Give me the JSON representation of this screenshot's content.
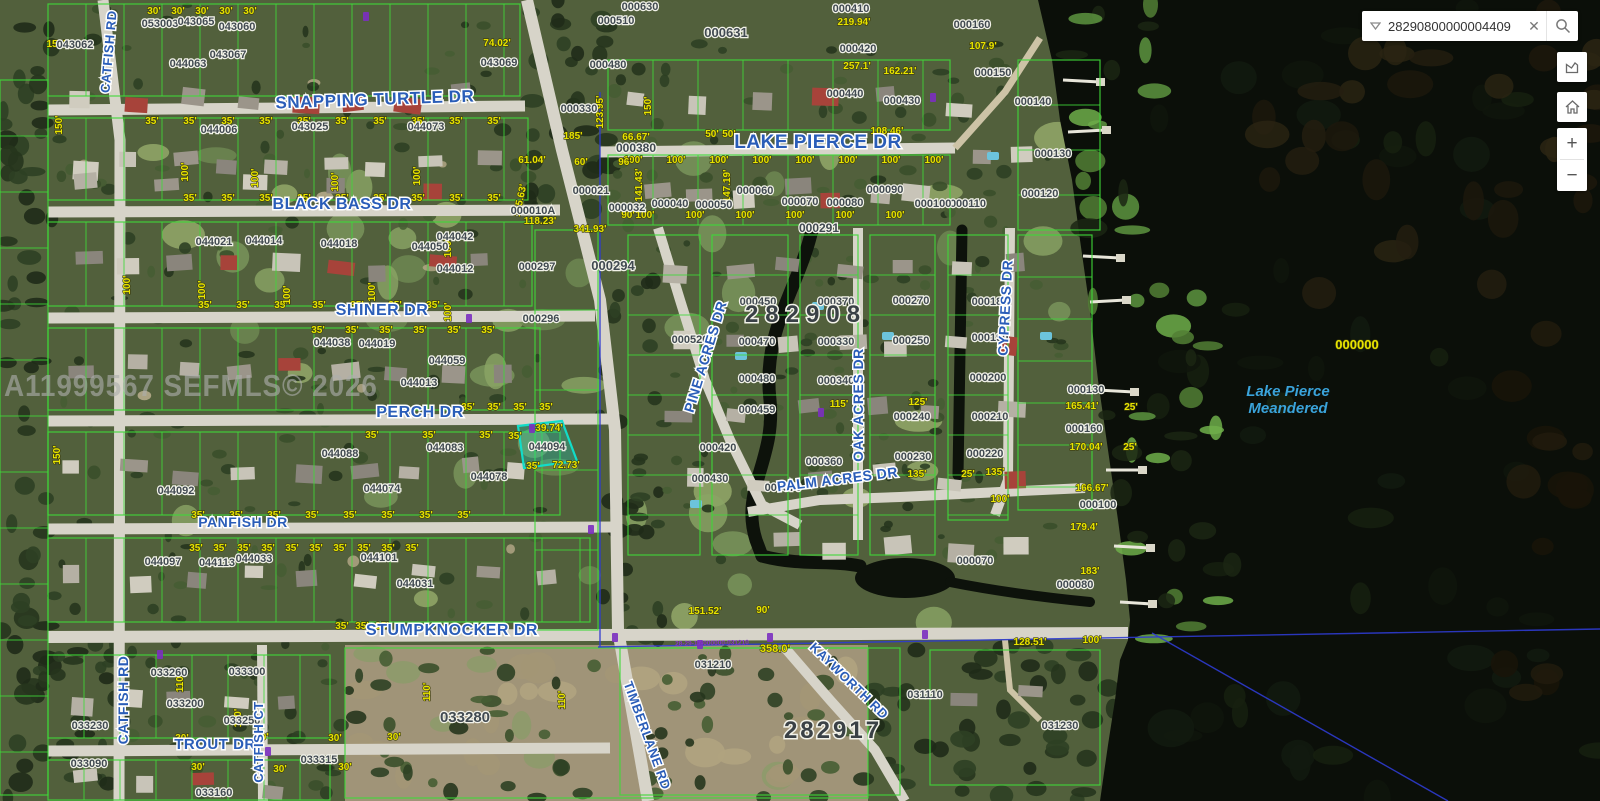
{
  "search": {
    "value": "28290800000004409"
  },
  "controls": {
    "zoom_in": "+",
    "zoom_out": "−"
  },
  "watermark": "A11999567 SEFMLS© 2026",
  "map": {
    "streets": [
      [
        "SNAPPING TURTLE DR",
        375,
        105,
        17,
        -2
      ],
      [
        "LAKE PIERCE DR",
        818,
        148,
        19,
        0
      ],
      [
        "BLACK BASS DR",
        342,
        209,
        16,
        0
      ],
      [
        "SHINER DR",
        382,
        315,
        16,
        0
      ],
      [
        "PERCH DR",
        420,
        417,
        16,
        0
      ],
      [
        "PANFISH DR",
        243,
        527,
        14,
        0
      ],
      [
        "STUMPKNOCKER DR",
        452,
        635,
        16,
        0
      ],
      [
        "TROUT DR",
        215,
        749,
        15,
        0
      ],
      [
        "CATFISH RD",
        113,
        52,
        13,
        -85
      ],
      [
        "CATFISH RD",
        128,
        700,
        14,
        -90
      ],
      [
        "CATFISH CT",
        263,
        742,
        13,
        -90
      ],
      [
        "PINE ACRES DR",
        710,
        358,
        14,
        -73
      ],
      [
        "OAK ACRES DR",
        863,
        405,
        14,
        -90
      ],
      [
        "CYPRESS DR",
        1010,
        308,
        14,
        -87
      ],
      [
        "PALM ACRES DR",
        838,
        484,
        14,
        -7
      ],
      [
        "KAYWORTH RD",
        846,
        684,
        13,
        44
      ],
      [
        "TIMBERLANE RD",
        643,
        737,
        13,
        70
      ]
    ],
    "sections": [
      [
        "282908",
        806,
        322,
        24,
        7
      ],
      [
        "282917",
        833,
        738,
        24,
        3
      ]
    ],
    "water_label": {
      "line1": "Lake Pierce",
      "line2": "Meandered"
    },
    "lake_parcel": "000000",
    "parcel_id_line": "28-29-17-000000-031210",
    "parcels": [
      [
        "000630",
        640,
        10
      ],
      [
        "000510",
        616,
        24
      ],
      [
        "000631",
        726,
        37,
        13
      ],
      [
        "000410",
        851,
        12
      ],
      [
        "000160",
        972,
        28
      ],
      [
        "000420",
        858,
        52
      ],
      [
        "000480",
        608,
        68
      ],
      [
        "000330",
        579,
        112
      ],
      [
        "000440",
        845,
        97
      ],
      [
        "000430",
        902,
        104
      ],
      [
        "000150",
        993,
        76
      ],
      [
        "000140",
        1033,
        105
      ],
      [
        "000130",
        1053,
        157
      ],
      [
        "000120",
        1040,
        197
      ],
      [
        "000110",
        968,
        207
      ],
      [
        "043062",
        75,
        48
      ],
      [
        "053003",
        160,
        27
      ],
      [
        "043065",
        196,
        25
      ],
      [
        "043060",
        237,
        30
      ],
      [
        "043067",
        228,
        58
      ],
      [
        "044063",
        188,
        67
      ],
      [
        "043069",
        499,
        66
      ],
      [
        "044006",
        219,
        133
      ],
      [
        "043025",
        310,
        130
      ],
      [
        "044073",
        426,
        130
      ],
      [
        "000380",
        636,
        152,
        12
      ],
      [
        "000032",
        627,
        211
      ],
      [
        "000040",
        670,
        207
      ],
      [
        "000050",
        714,
        208
      ],
      [
        "000060",
        755,
        194
      ],
      [
        "000070",
        800,
        205
      ],
      [
        "000080",
        845,
        206
      ],
      [
        "000090",
        885,
        193
      ],
      [
        "000100",
        933,
        207
      ],
      [
        "000291",
        819,
        232,
        12
      ],
      [
        "044021",
        214,
        245
      ],
      [
        "044014",
        264,
        244
      ],
      [
        "044018",
        339,
        247
      ],
      [
        "044050",
        430,
        250
      ],
      [
        "044042",
        455,
        240
      ],
      [
        "044012",
        455,
        272
      ],
      [
        "000010A",
        533,
        214
      ],
      [
        "000021",
        591,
        194
      ],
      [
        "000297",
        537,
        270
      ],
      [
        "000294",
        613,
        270,
        13
      ],
      [
        "000296",
        541,
        322
      ],
      [
        "044038",
        332,
        346
      ],
      [
        "044019",
        377,
        347
      ],
      [
        "044059",
        447,
        364
      ],
      [
        "044013",
        419,
        386
      ],
      [
        "044088",
        340,
        457
      ],
      [
        "044083",
        445,
        451
      ],
      [
        "044078",
        489,
        480
      ],
      [
        "044094",
        547,
        450
      ],
      [
        "044092",
        176,
        494
      ],
      [
        "044074",
        382,
        492
      ],
      [
        "044097",
        163,
        565
      ],
      [
        "044113",
        217,
        566
      ],
      [
        "044033",
        254,
        562
      ],
      [
        "044101",
        379,
        561
      ],
      [
        "044031",
        415,
        587
      ],
      [
        "033260",
        169,
        676
      ],
      [
        "033300",
        247,
        675
      ],
      [
        "033200",
        185,
        707
      ],
      [
        "033230",
        90,
        729
      ],
      [
        "033250",
        242,
        724
      ],
      [
        "033090",
        89,
        767
      ],
      [
        "033315",
        319,
        763
      ],
      [
        "033160",
        214,
        796
      ],
      [
        "033280",
        465,
        722,
        15
      ],
      [
        "031210",
        713,
        668
      ],
      [
        "031110",
        925,
        698
      ],
      [
        "031230",
        1060,
        729
      ],
      [
        "000450",
        758,
        305
      ],
      [
        "000370",
        836,
        305
      ],
      [
        "000270",
        911,
        304
      ],
      [
        "000180",
        990,
        305
      ],
      [
        "000520",
        690,
        343
      ],
      [
        "000470",
        757,
        345
      ],
      [
        "000330",
        836,
        345
      ],
      [
        "000250",
        911,
        344
      ],
      [
        "000190",
        990,
        341
      ],
      [
        "000480",
        757,
        382
      ],
      [
        "000340",
        836,
        384
      ],
      [
        "000240",
        912,
        420
      ],
      [
        "000200",
        988,
        381
      ],
      [
        "000210",
        990,
        420
      ],
      [
        "000230",
        913,
        460
      ],
      [
        "000220",
        985,
        457
      ],
      [
        "000459",
        757,
        413
      ],
      [
        "000420",
        718,
        451
      ],
      [
        "000430",
        710,
        482
      ],
      [
        "000360",
        824,
        465
      ],
      [
        "000370",
        783,
        491
      ],
      [
        "000100",
        1098,
        508
      ],
      [
        "000080",
        1075,
        588
      ],
      [
        "000070",
        975,
        564
      ],
      [
        "000130",
        1086,
        393
      ],
      [
        "000160",
        1084,
        432
      ]
    ],
    "dims": [
      [
        "74.02'",
        497,
        46
      ],
      [
        "61.04'",
        532,
        163
      ],
      [
        "108.46'",
        887,
        134
      ],
      [
        "50'",
        712,
        137
      ],
      [
        "50'",
        729,
        137
      ],
      [
        "219.94'",
        854,
        25
      ],
      [
        "257.1'",
        857,
        69
      ],
      [
        "162.21'",
        900,
        74
      ],
      [
        "107.9'",
        983,
        49
      ],
      [
        "118.23'",
        540,
        224
      ],
      [
        "341.93'",
        590,
        232
      ],
      [
        "185'",
        573,
        139
      ],
      [
        "66.67'",
        636,
        140
      ],
      [
        "60'",
        581,
        165
      ],
      [
        "96'",
        625,
        165
      ],
      [
        "90'",
        628,
        218
      ],
      [
        "358.0'",
        775,
        652,
        0,
        11
      ],
      [
        "128.51'",
        1030,
        645
      ],
      [
        "100'",
        1092,
        643
      ],
      [
        "151.52'",
        705,
        614
      ],
      [
        "90'",
        763,
        613
      ],
      [
        "39.74'",
        549,
        431
      ],
      [
        "35'",
        515,
        439
      ],
      [
        "35'",
        533,
        469
      ],
      [
        "72.73'",
        566,
        468
      ],
      [
        "165.41'",
        1082,
        409
      ],
      [
        "170.04'",
        1086,
        450
      ],
      [
        "166.67'",
        1092,
        491
      ],
      [
        "179.4'",
        1084,
        530
      ],
      [
        "183'",
        1090,
        574
      ],
      [
        "25'",
        1131,
        410
      ],
      [
        "25'",
        1130,
        450
      ],
      [
        "115'",
        839,
        407
      ],
      [
        "125'",
        918,
        405
      ],
      [
        "135'",
        917,
        477
      ],
      [
        "25'",
        968,
        477
      ],
      [
        "135'",
        995,
        475
      ],
      [
        "100'",
        1000,
        502
      ],
      [
        "150'",
        56,
        47
      ],
      [
        "123.95'",
        603,
        112,
        -90
      ],
      [
        "150'",
        651,
        106,
        -90
      ],
      [
        "141.43'",
        642,
        185,
        -90
      ],
      [
        "147.19'",
        730,
        186,
        -90
      ],
      [
        "145.63'",
        523,
        201,
        -78
      ],
      [
        "100'",
        188,
        172,
        -90
      ],
      [
        "100'",
        258,
        178,
        -90
      ],
      [
        "100'",
        338,
        182,
        -90
      ],
      [
        "100'",
        420,
        176,
        -90
      ],
      [
        "100'",
        130,
        285,
        -90
      ],
      [
        "100'",
        205,
        290,
        -90
      ],
      [
        "100'",
        290,
        295,
        -90
      ],
      [
        "100'",
        375,
        292,
        -90
      ],
      [
        "100'",
        451,
        248,
        -90
      ],
      [
        "100'",
        451,
        312,
        -90
      ],
      [
        "110'",
        183,
        683,
        -90
      ],
      [
        "110'",
        241,
        718,
        -90
      ],
      [
        "110'",
        430,
        692,
        -90
      ],
      [
        "110'",
        565,
        700,
        -90
      ],
      [
        "150'",
        62,
        125,
        -90
      ],
      [
        "150'",
        60,
        455,
        -90
      ],
      [
        "30'",
        182,
        741
      ],
      [
        "30'",
        262,
        740
      ],
      [
        "30'",
        335,
        741
      ],
      [
        "30'",
        394,
        740
      ],
      [
        "30'",
        198,
        770
      ],
      [
        "30'",
        280,
        772
      ],
      [
        "30'",
        345,
        770
      ],
      [
        "000000",
        1357,
        349,
        0,
        13
      ]
    ],
    "dim_rows": [
      [
        "35'",
        124,
        152,
        38,
        10
      ],
      [
        "35'",
        201,
        190,
        38,
        9
      ],
      [
        "35'",
        308,
        205,
        38,
        7
      ],
      [
        "35'",
        333,
        318,
        34,
        6
      ],
      [
        "35'",
        410,
        468,
        26,
        4
      ],
      [
        "35'",
        438,
        372,
        57,
        3
      ],
      [
        "35'",
        518,
        198,
        38,
        8
      ],
      [
        "35'",
        551,
        196,
        24,
        10
      ],
      [
        "35'",
        629,
        342,
        20,
        3
      ],
      [
        "100'",
        163,
        633,
        43,
        8
      ],
      [
        "100'",
        218,
        645,
        50,
        6
      ],
      [
        "30'",
        14,
        154,
        24,
        5
      ]
    ]
  }
}
